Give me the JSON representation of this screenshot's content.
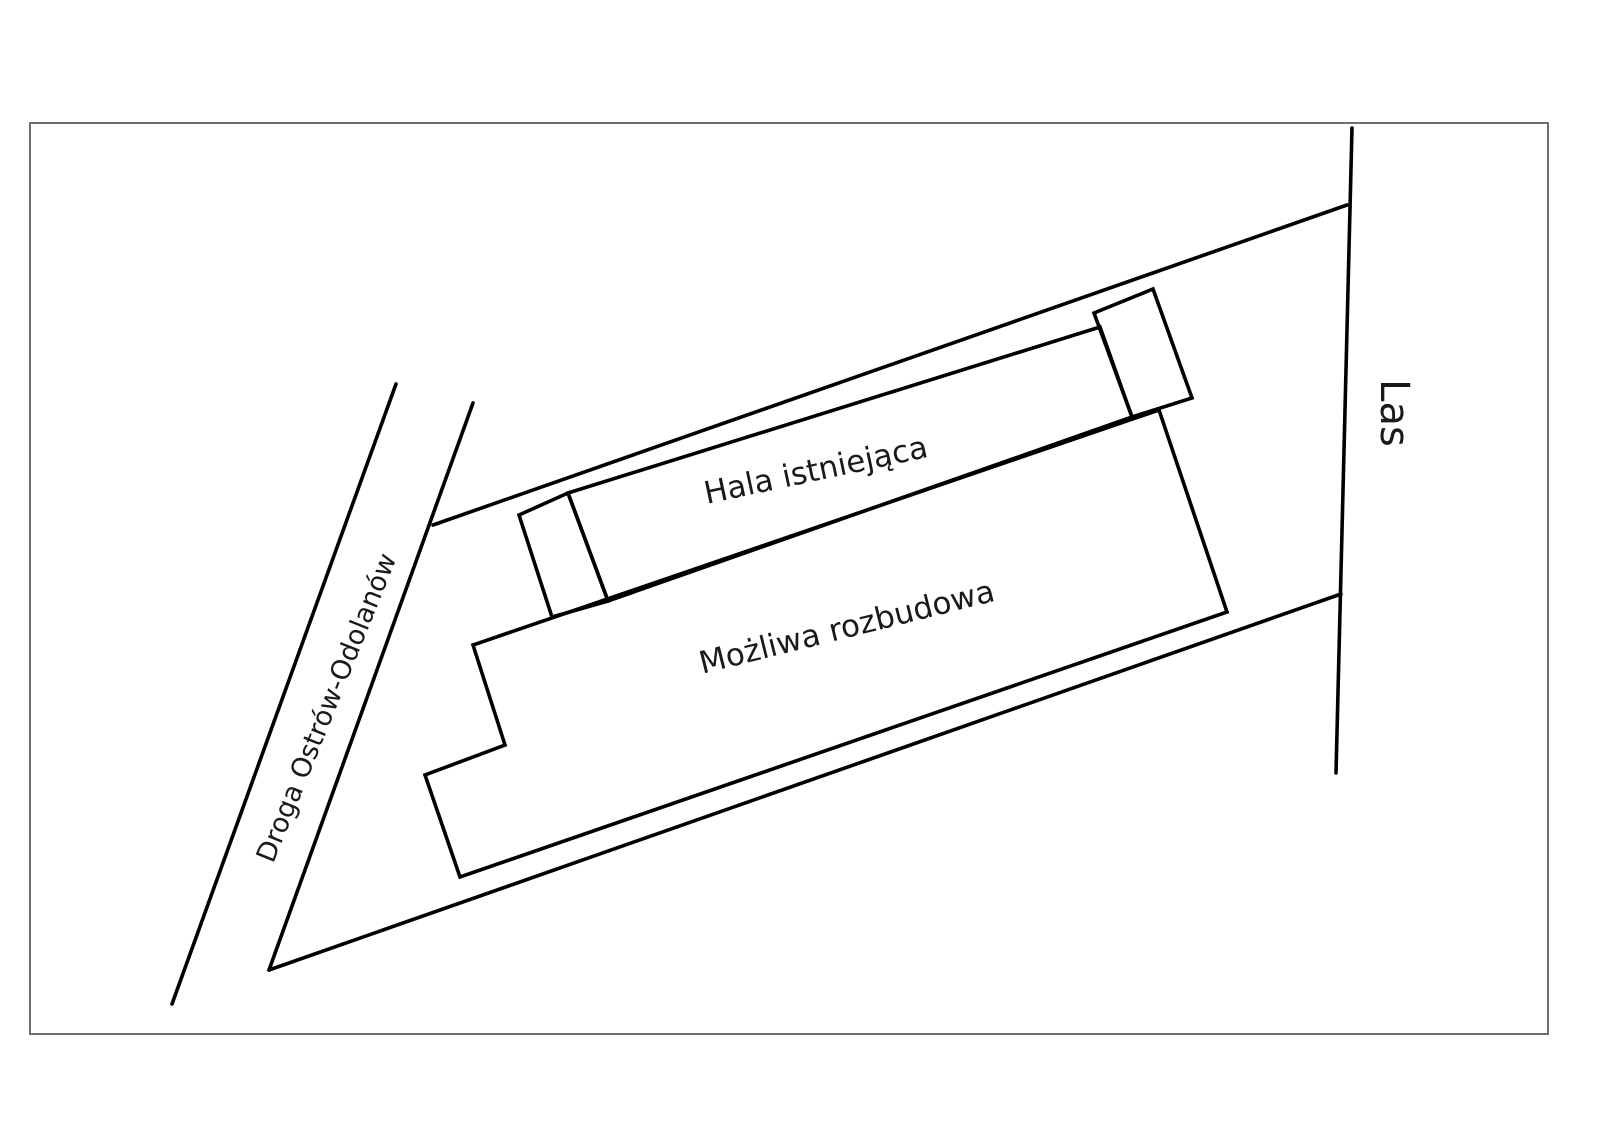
{
  "page": {
    "background": "#ffffff"
  },
  "diagram": {
    "labels": {
      "hall": "Hala istniejąca",
      "expansion": "Możliwa rozbudowa",
      "road": "Droga Ostrów-Odolanów",
      "forest": "Las"
    },
    "colors": {
      "line": "#000000",
      "text": "#1a1a1a",
      "frame": "#6e6e6e"
    },
    "shapes": {
      "expansion_building": "473,645 505,745 425,775 460,877 1227,612 1159,410",
      "hall_building": "568,493 1100,327 1132,417 608,601",
      "left_annex": "519,515 568,493 608,601 552,617",
      "right_annex": "1094,313 1153,289 1192,398 1132,417",
      "road_left_line": "396,384 172,1004",
      "road_right_line": "473,403 269,970",
      "boundary_top": "433,525 1347,205",
      "boundary_bottom": "269,970 1341,594",
      "forest_line": "1352,128 1336,773",
      "frame_rect": "30,123 1548,123 1548,1034 30,1034"
    }
  }
}
